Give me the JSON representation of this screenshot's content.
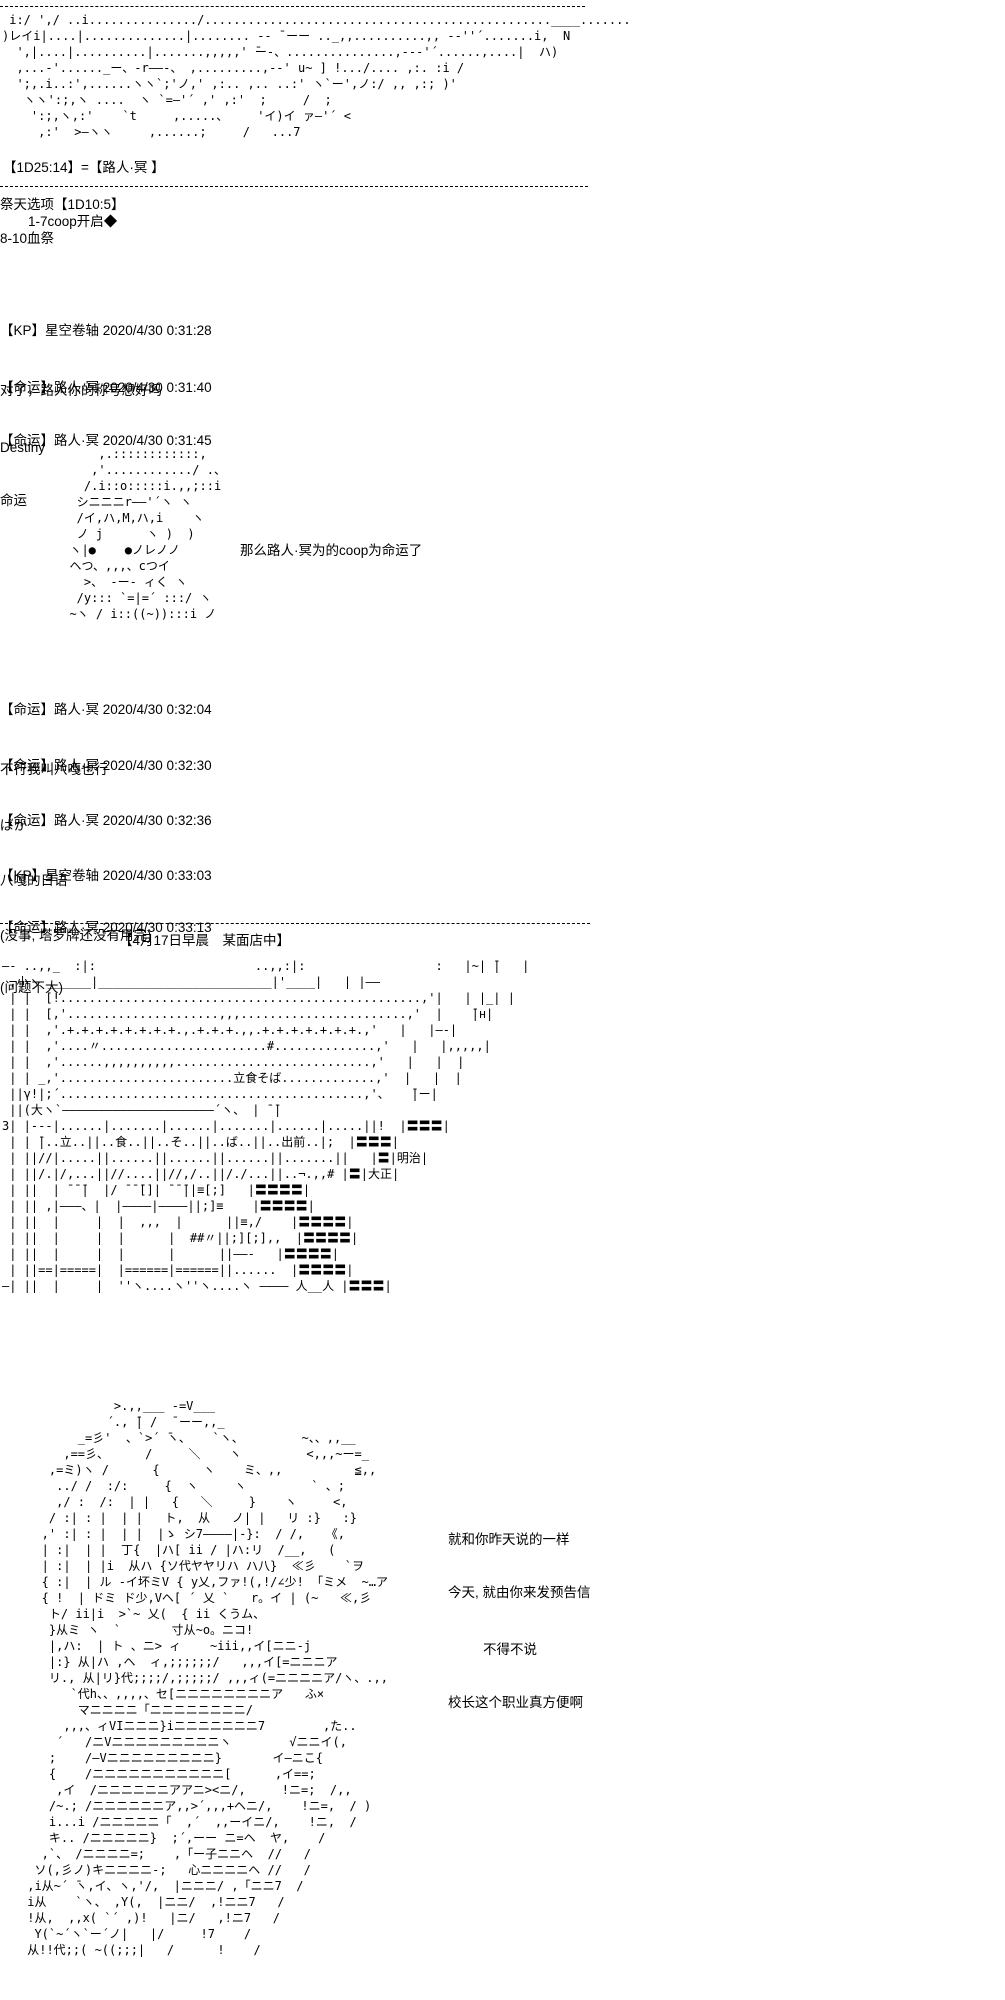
{
  "page": {
    "background": "#ffffff",
    "text_color": "#000000"
  },
  "dice": {
    "naming_roll": "【1D25:14】=【路人·冥 】",
    "ritual_title": "祭天选项【1D10:5】",
    "ritual_option_1": "1-7coop开启◆",
    "ritual_option_2": "8-10血祭"
  },
  "scene_header": "【4月17日早晨　某面店中】",
  "messages": [
    {
      "header": "【KP】星空卷轴 2020/4/30 0:31:28",
      "body": "对了，路人你的称号想好吗"
    },
    {
      "header": "【命运】路人·冥 2020/4/30 0:31:40",
      "body": "Destiny"
    },
    {
      "header": "【命运】路人·冥 2020/4/30 0:31:45",
      "body": "命运"
    },
    {
      "header": "【命运】路人·冥 2020/4/30 0:32:04",
      "body": "不行我叫八嘎也行"
    },
    {
      "header": "【命运】路人·冥 2020/4/30 0:32:30",
      "body": "ばか"
    },
    {
      "header": "【命运】路人·冥 2020/4/30 0:32:36",
      "body": "八嘎的日语"
    },
    {
      "header": "【KP】星空卷轴 2020/4/30 0:33:03",
      "body": "(没事, 塔罗牌还没有用完)"
    },
    {
      "header": "【命运】路人·冥 2020/4/30 0:33:13",
      "body": "(问题不大)"
    }
  ],
  "aa": {
    "top_character": [
      " i:/ ',/ ..i.............../................................................____.......",
      ")レイi|....|..............|........ -‐ ̄ ーー .._,,..........,, -‐''´.......i,  N",
      "  ',|....|..........|.......,,,,,' ̄ー-、...............,--‐'´......,....|  ハ)",
      "  ,...-'......_ー、-r――-、 ,.........,-‐' u~ ] !.../.... ,:. :i /",
      "  ';,.i..:',......ヽヽ`;'ノ,' ,:.. ,.. ..:' ヽ`ー',ノ:/ ,, ,:; )'",
      "   ヽヽ':;,ヽ ....  ヽ `=―'´ ,' ,:'  ;     /  ;",
      "    ':;,ヽ,:'    `t     ,.....、    'イ)イ ァ―'´ <",
      "     ,:'  >―ヽヽ     ,......;     /   ...7"
    ],
    "chibi_character": [
      "      ,.::::::::::::,",
      "     ,'............/ .、",
      "    /.i::o:::::i.,,;::i",
      "   シニニニr――'´ヽ ヽ",
      "   /イ,ハ,M,ハ,i    ヽ",
      "   ノ j      ヽ )  )",
      "  ヽ|●    ●ノレノノ",
      "  ヘつ、,,,、cつイ",
      "    >、 -ー- ィく ヽ",
      "   /y::: `=|=´ :::/ ヽ",
      "  ~ヽ / i::((~)):::i ノ"
    ],
    "chibi_caption": "那么路人·冥为的coop为命运了",
    "soba_shop": [
      "―- ..,,_  :|:                      ..,,:|:                  :   |~| ̄|   |",
      " ,小ヽ ______|________________________|'____|   | |――",
      " | |  [!..................................................,'|   | |_| |",
      " | |  [,'.....................,,,.......................,'  |    ̄|н|",
      " | |  ,'.+.+.+.+.+.+.+.+.,.+.+.+.,,.+.+.+.+.+.+.+.,'   |   |―‐|",
      " | |  ,'....〃.......................#..............,'   |   |,,,,,|",
      " | |  ,'......,,,,,,,,,,...........................,'   |   |  |",
      " | | _,'........................立食そば.............,'  |   |  |",
      " ||γ!|;´..........................................,'、   ̄|ー|",
      " ||(大ヽ`―――――――――――――――――――――´ヽ、 | ̄ ̄|",
      "3| |---|......|.......|......|.......|......|.....||!  |〓〓〓|",
      " | | ̄|..立..||..食..||..そ..||..ば..||..出前..|;  |〓〓〓|",
      " | ||//|.....||......||......||......||.......||   |〓|明治|",
      " | ||/.|/,...||//....||//,/..||/./...||..¬.,,# |〓|大正|",
      " | ||  | ̄ ̄ ̄|  |/ ̄ ̄ ̄[]| ̄ ̄ ̄||≡[;]   |〓〓〓〓|",
      " | || ,|―――、|  |――――|――――||;]≡    |〓〓〓〓|",
      " | ||  |     |  |  ,,,  |      ||≡,/    |〓〓〓〓|",
      " | ||  |     |  |      |  ##〃||;][;],,  |〓〓〓〓|",
      " | ||  |     |  |      |      ||――-   |〓〓〓〓|",
      " | ||==|=====|  |======|======||......  |〓〓〓〓|",
      "―| ||  |     |  ''ヽ....ヽ''ヽ....ヽ ―――― 人__人 |〓〓〓|"
    ],
    "pupil_character": [
      "             >.,,___ -=V___",
      "            ´., ̄| /  ̄ ーー,,_",
      "        _=彡'  、`>´ ̄ヽ、   `ヽ、        ~、、,,__",
      "      ,==彡、     /     ＼    ヽ         <,,,~ー=_",
      "    ,=ミ)ヽ /      {      ヽ    ミ、,,          ≦,,",
      "     ../ /  :/:     {  ヽ     ヽ         ` 、;",
      "     ,/ :  /:  | |   {   ＼     }    ヽ     <,",
      "    / :| : |  | |   ト,  从   ノ| |   リ :}   :}",
      "   ,' :| : |  | |  |ゝ シ7――――|-}:  / /,   《,",
      "   | :|  | |  丁{  |ハ[ ii / |ハ:リ  /__,   (",
      "   | :|  | |i  从ハ {ソ代ヤヤリハ ハ八}  ≪彡    `ヲ",
      "   { :|  | ル -イ坏ミV { y乂,ファ!(,!/∠少! 「ミメ  ~…ア",
      "   { !  | ドミ ド少,Vヘ[ ´ 乂 `   r。イ | (~   ≪,彡",
      "    ト/ ii|i  >`~ 乂(  { ii くうム、",
      "    }从ミ ヽ  `       寸从~o。ニコ!",
      "    |,ハ:  | ト 、ニ> ィ    ~iii,,イ[ニニ-j",
      "    |:} 从|ハ ,ヘ  ィ,;;;;;;/   ,,,イ[=ニニニア",
      "    リ., 从|リ}代;;;;/,;;;;;/ ,,,ィ(=ニニニニア/ヽ、.,,",
      "       `代h、、,,,,、セ[ニニニニニニニニア   ふ×",
      "        マニニニニ「ニニニニニニニニ/",
      "      ,,,、ィVIニニニ}iニニニニニニニ7        ,た..",
      "     ´   /ニVニニニニニニニニニヽ        √ニニイ(,",
      "    ;    /―Vニニニニニニニニニ}       イ―ニこ{",
      "    {    /ニニニニニニニニニニニ[      ,イ==;",
      "     ,イ  /ニニニニニニアアニ><ニ/,     !ニ=;  /,,",
      "    /~.; /ニニニニニニア,,>´,,,+ヘニ/,    !ニ=,  / )",
      "    i...i /ニニニニニ「  ,´  ,,ーイニ/,    !ニ,  /",
      "    キ.. /ニニニニニ}  ;´,ーー ニ=ヘ  ヤ,    /",
      "   ,`、 /ニニニニ=;    ,「ー子ニニヘ  //   /",
      "  ソ(,彡ノ)キニニニニ-;   心ニニニニヘ //   /",
      " ,i从~´ ̄ヽ,イ、ヽ,'/,  |ニニニ/ ,「ニニ7  /",
      " i从    `ヽ、 ,Y(,  |ニニ/  ,!ニニ7   /",
      " !从,  ,,х( `´ ,)!   |ニ/   ,!ニ7   /",
      "  Y(`~´ヽ`ー´ノ|   |/     !7    /",
      " 从!!代;;( ~((;;;|   /      !    /"
    ],
    "pupil_dialogue": [
      "就和你昨天说的一样",
      "今天, 就由你来发预告信",
      "不得不说",
      "校长这个职业真方便啊"
    ]
  }
}
